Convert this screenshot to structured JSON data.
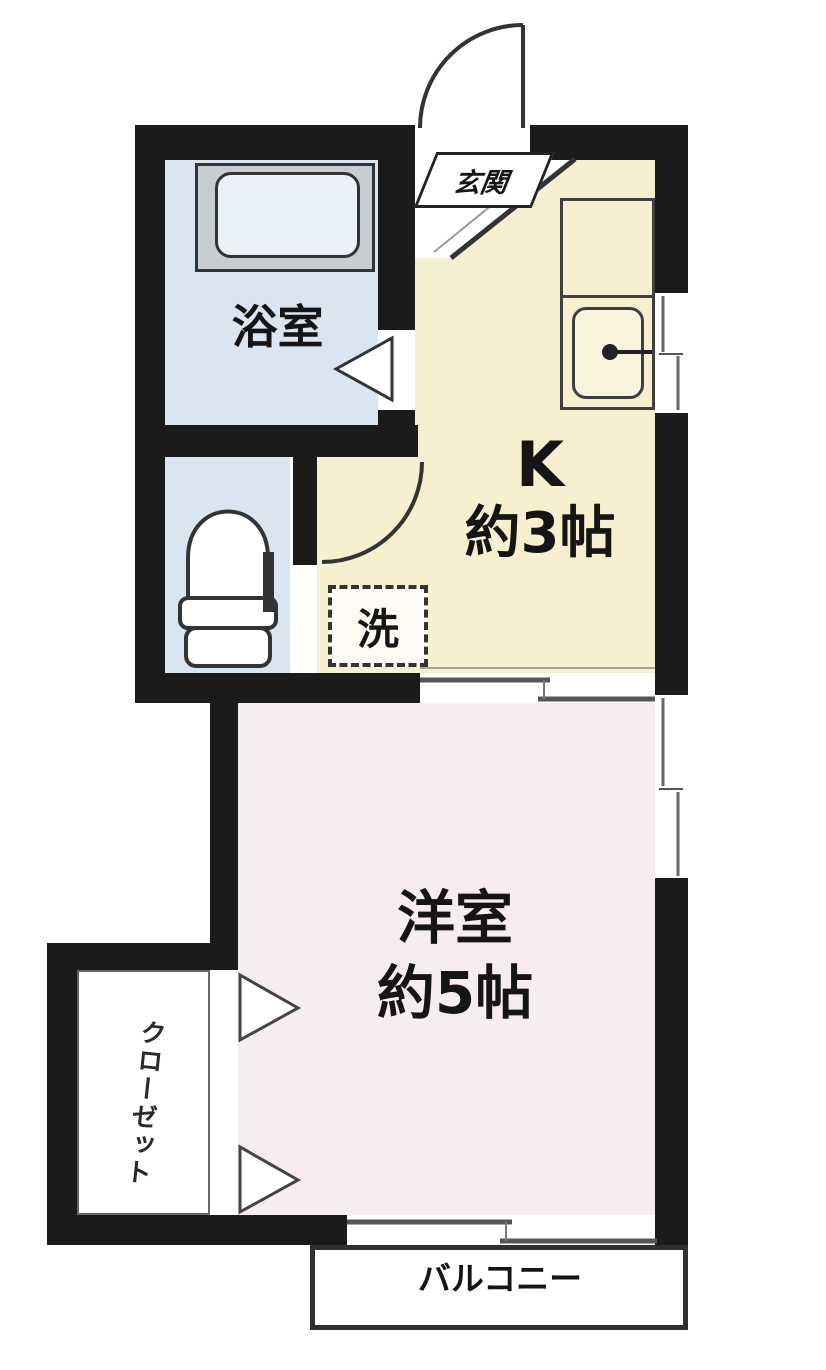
{
  "rooms": {
    "entrance": {
      "label": "玄関"
    },
    "bathroom": {
      "label": "浴室"
    },
    "kitchen": {
      "label": "K",
      "size": "約3帖"
    },
    "laundry": {
      "label": "洗"
    },
    "western_room": {
      "label": "洋室",
      "size": "約5帖"
    },
    "closet": {
      "label": "クローゼット"
    },
    "balcony": {
      "label": "バルコニー"
    }
  },
  "fixtures": {
    "bathtub_icon": "bathtub",
    "toilet_icon": "toilet",
    "kitchen_sink_icon": "kitchen-sink-with-faucet",
    "entrance_door_icon": "swing-door-arc",
    "hall_door_icon": "swing-door-arc",
    "bathroom_door_icon": "folding-door-triangle",
    "closet_door_icons": "double-hinged-door-triangles",
    "sliding_door_icons": "sliding-door-double-line",
    "window_icons": "sliding-window"
  },
  "colors": {
    "wall": "#1b1b1b",
    "kitchen_floor": "#f6efd0",
    "western_room_floor": "#f8ecf3",
    "bathroom_floor": "#d9e5f1",
    "toilet_floor": "#d9e5f1",
    "tub_surround": "#c8cdd2",
    "outline": "#333333",
    "background": "#ffffff"
  }
}
